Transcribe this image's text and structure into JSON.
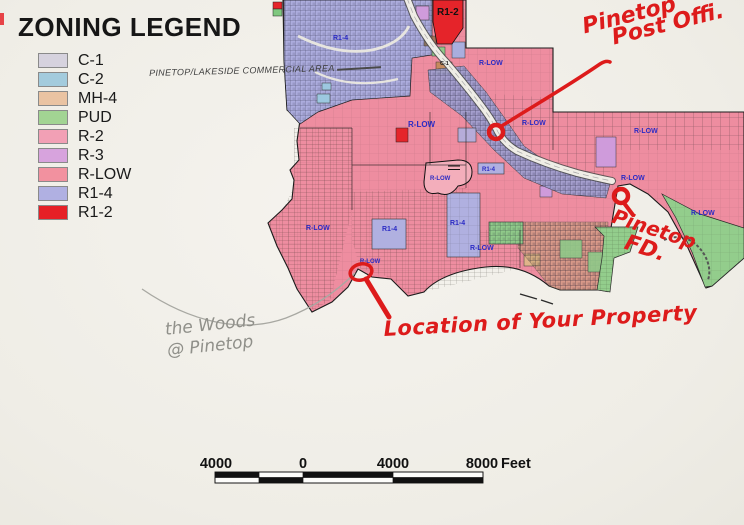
{
  "paper_color": "#f2f0ea",
  "legend": {
    "title": "ZONING LEGEND",
    "items": [
      {
        "code": "C-1",
        "color": "#d6d2de"
      },
      {
        "code": "C-2",
        "color": "#a3cbdd",
        "note": "PINETOP/LAKESIDE COMMERCIAL AREA"
      },
      {
        "code": "MH-4",
        "color": "#eac3a2"
      },
      {
        "code": "PUD",
        "color": "#a2d493"
      },
      {
        "code": "R-2",
        "color": "#f2a0b5"
      },
      {
        "code": "R-3",
        "color": "#d7a3dd"
      },
      {
        "code": "R-LOW",
        "color": "#f2919f"
      },
      {
        "code": "R1-4",
        "color": "#b0b0e2"
      },
      {
        "code": "R1-2",
        "color": "#e62026"
      }
    ]
  },
  "map": {
    "label_color": "#2b2bc4",
    "zone_labels": [
      {
        "text": "R-LOW",
        "x": 408,
        "y": 127,
        "size": 8
      },
      {
        "text": "R-LOW",
        "x": 479,
        "y": 65,
        "size": 7
      },
      {
        "text": "R-LOW",
        "x": 522,
        "y": 125,
        "size": 7
      },
      {
        "text": "R-LOW",
        "x": 634,
        "y": 133,
        "size": 7
      },
      {
        "text": "R-LOW",
        "x": 621,
        "y": 180,
        "size": 7
      },
      {
        "text": "R-LOW",
        "x": 691,
        "y": 215,
        "size": 7
      },
      {
        "text": "R-LOW",
        "x": 306,
        "y": 230,
        "size": 7
      },
      {
        "text": "R-LOW",
        "x": 360,
        "y": 263,
        "size": 6
      },
      {
        "text": "R-LOW",
        "x": 430,
        "y": 180,
        "size": 6
      },
      {
        "text": "R-LOW",
        "x": 470,
        "y": 250,
        "size": 7
      },
      {
        "text": "R1-4",
        "x": 333,
        "y": 40,
        "size": 7
      },
      {
        "text": "R1-4",
        "x": 382,
        "y": 231,
        "size": 7
      },
      {
        "text": "R1-4",
        "x": 450,
        "y": 225,
        "size": 7
      },
      {
        "text": "R1-4",
        "x": 482,
        "y": 171,
        "size": 6
      },
      {
        "text": "R1-2",
        "x": 437,
        "y": 15,
        "size": 10,
        "color": "#111111"
      },
      {
        "text": "C-1",
        "x": 440,
        "y": 65,
        "size": 5.5,
        "color": "#222222"
      }
    ]
  },
  "annotations": {
    "ink_color": "#dd1b1b",
    "pencil_color": "#90908a",
    "post_office": {
      "line1": "Pinetop",
      "line2": "Post Offi."
    },
    "fire_dept": {
      "line1": "Pinetop",
      "line2": "FD."
    },
    "property": {
      "text": "Location of Your Property"
    },
    "pencil": {
      "line1": "the Woods",
      "line2": "@ Pinetop"
    }
  },
  "scale_bar": {
    "ticks": [
      "4000",
      "0",
      "4000",
      "8000"
    ],
    "unit": "Feet"
  }
}
